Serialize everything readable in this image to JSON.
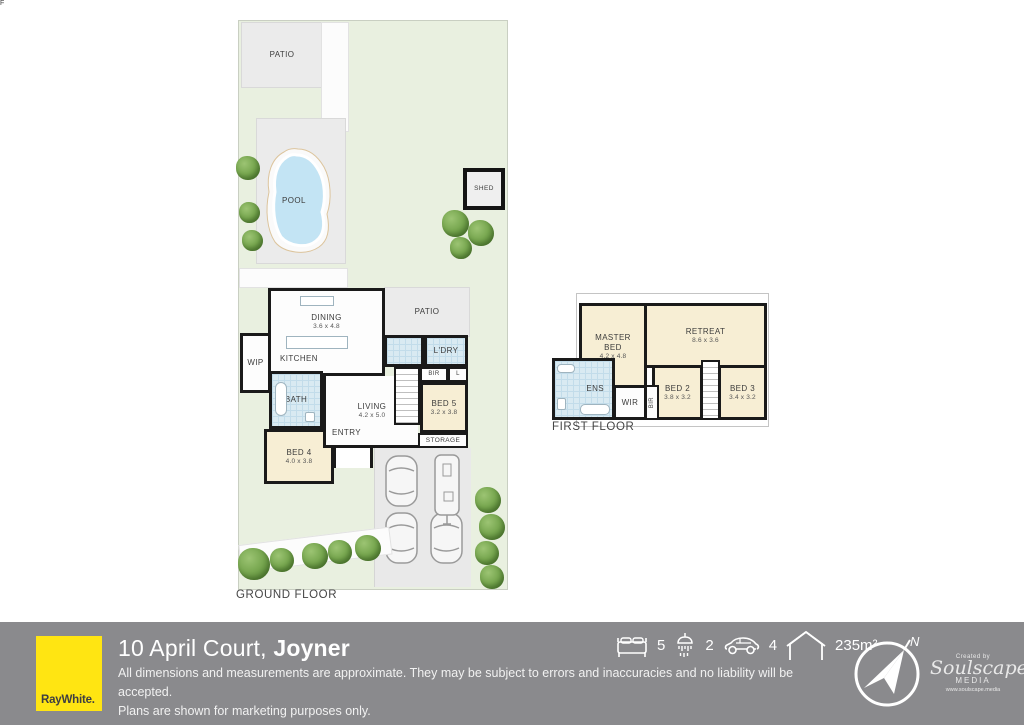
{
  "colors": {
    "accent_yellow": "#ffe512",
    "footer_gray": "#8a8a8d",
    "grass_green": "#e9f0e0",
    "room_cream": "#f7eed4",
    "wet_blue": "#d9eaf2",
    "pool_blue": "#c3e4f4",
    "wall_black": "#1a1a1a"
  },
  "ground_floor": {
    "floor_label": "GROUND FLOOR",
    "outdoor": {
      "patio_yard": "PATIO",
      "pool": "POOL",
      "shed": "SHED",
      "patio_house": "PATIO"
    },
    "rooms": {
      "dining": {
        "name": "DINING",
        "dims": "3.6 x 4.8"
      },
      "kitchen": {
        "name": "KITCHEN"
      },
      "fridge": {
        "name": "F"
      },
      "wip": {
        "name": "WIP"
      },
      "bath": {
        "name": "BATH"
      },
      "living": {
        "name": "LIVING",
        "dims": "4.2 x 5.0"
      },
      "entry": {
        "name": "ENTRY"
      },
      "bed4": {
        "name": "BED 4",
        "dims": "4.0 x 3.8"
      },
      "bed5": {
        "name": "BED 5",
        "dims": "3.2 x 3.8"
      },
      "ldry": {
        "name": "L'DRY"
      },
      "bir": {
        "name": "BIR"
      },
      "linen": {
        "name": "L"
      },
      "storage": {
        "name": "STORAGE"
      }
    }
  },
  "first_floor": {
    "floor_label": "FIRST FLOOR",
    "rooms": {
      "master": {
        "name": "MASTER BED",
        "dims": "4.2 x 4.8"
      },
      "retreat": {
        "name": "RETREAT",
        "dims": "8.6 x 3.6"
      },
      "bed2": {
        "name": "BED 2",
        "dims": "3.8 x 3.2"
      },
      "bed3": {
        "name": "BED 3",
        "dims": "3.4 x 3.2"
      },
      "ens": {
        "name": "ENS"
      },
      "wir": {
        "name": "WIR"
      },
      "bir": {
        "name": "BIR"
      }
    }
  },
  "footer": {
    "brand": "RayWhite.",
    "address_regular": "10 April Court, ",
    "address_bold": "Joyner",
    "disclaimer_line1": "All dimensions and measurements are approximate. They may be subject to errors and inaccuracies and no liability will be accepted.",
    "disclaimer_line2": "Plans are shown for marketing purposes only.",
    "stats": {
      "beds": "5",
      "baths": "2",
      "cars": "4",
      "area": "235m²"
    },
    "compass_north": "N",
    "credit": {
      "created_by": "Created by",
      "name": "Soulscape",
      "media": "MEDIA",
      "url": "www.soulscape.media"
    }
  }
}
